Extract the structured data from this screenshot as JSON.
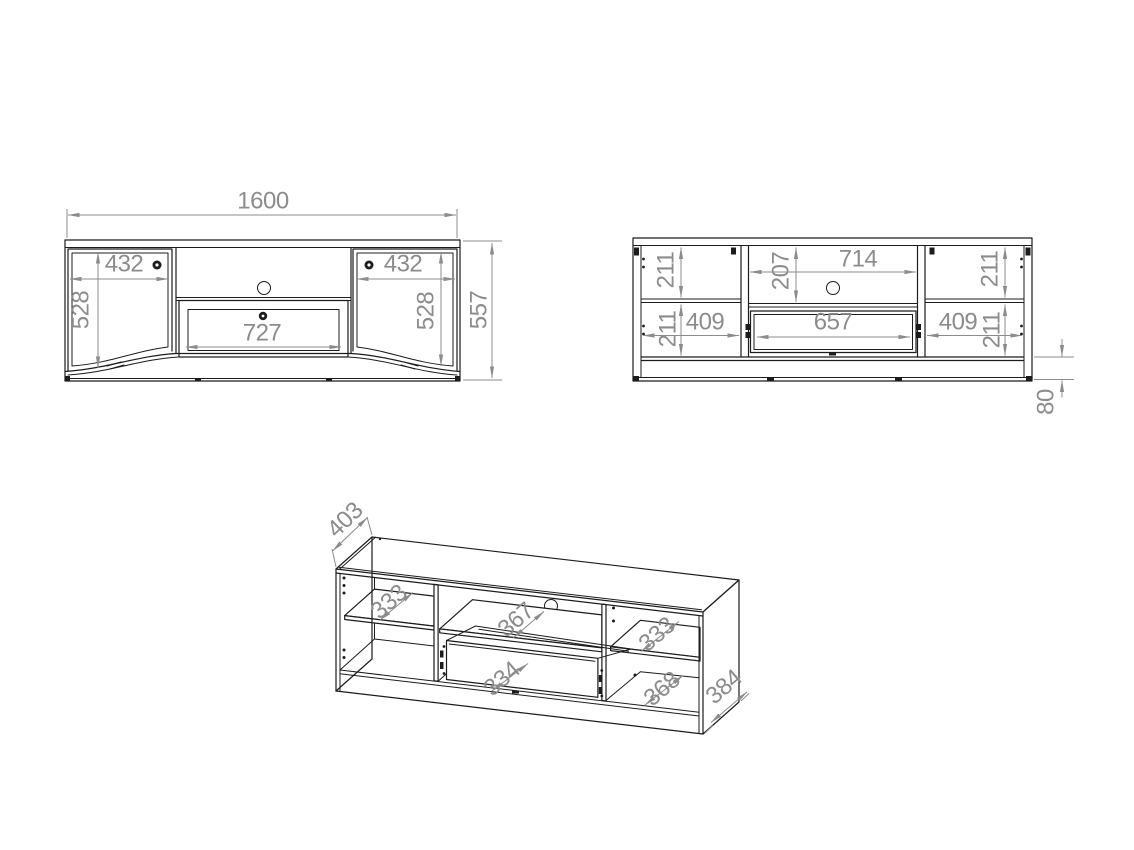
{
  "drawing_type": "furniture technical drawing - TV stand, three views",
  "colors": {
    "line": "#1c1c1c",
    "dimension": "#8c8c8c",
    "background": "#ffffff"
  },
  "front_view": {
    "width": "1600",
    "height": "557",
    "left_door_width": "432",
    "right_door_width": "432",
    "left_side_height": "528",
    "right_side_height": "528",
    "drawer_width": "727"
  },
  "internal_view": {
    "top_left_height": "211",
    "niche_height": "207",
    "niche_width": "714",
    "top_right_height": "211",
    "bottom_left_height": "211",
    "left_niche_width": "409",
    "drawer_inner_width": "657",
    "right_niche_width": "409",
    "bottom_right_height": "211",
    "plinth_height": "80"
  },
  "iso_view": {
    "top_depth": "403",
    "left_shelf_depth": "333",
    "middle_shelf_depth": "367",
    "drawer_depth": "334",
    "right_shelf_depth": "333",
    "right_bottom_depth": "368",
    "side_depth": "384"
  }
}
